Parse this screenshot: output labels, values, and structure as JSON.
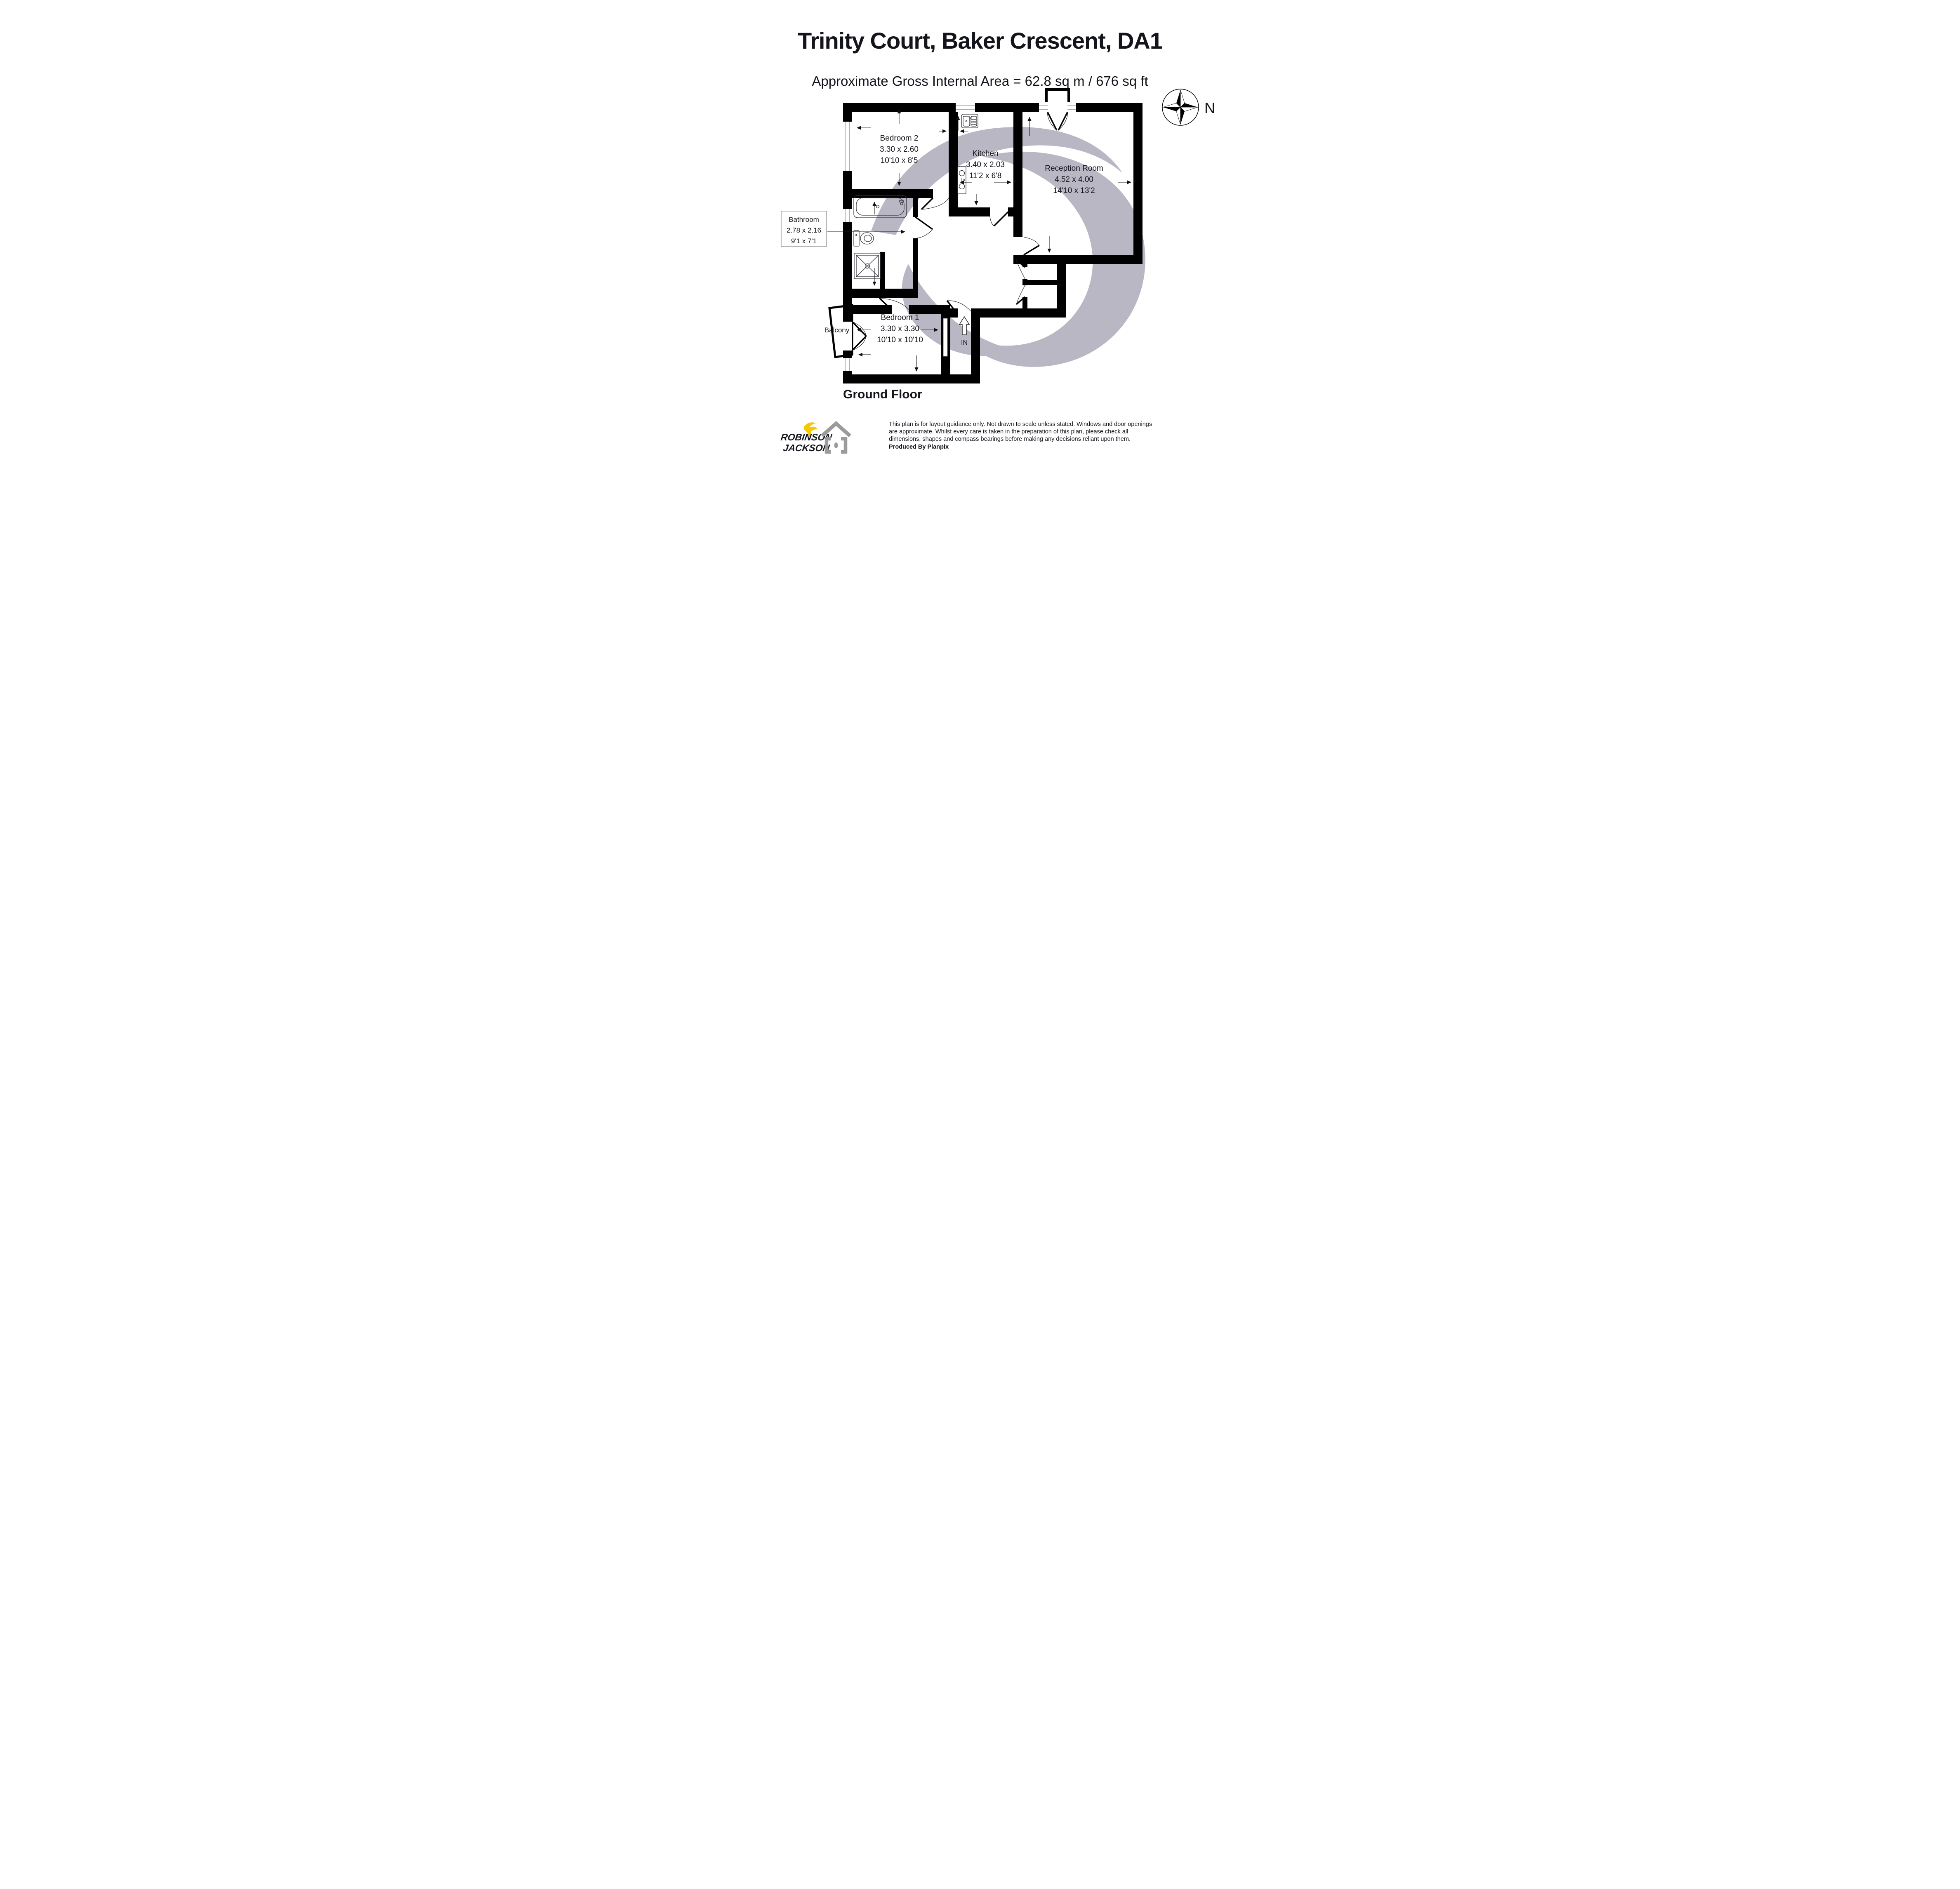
{
  "header": {
    "title": "Trinity Court, Baker Crescent, DA1",
    "subtitle": "Approximate Gross Internal Area = 62.8 sq m / 676 sq ft"
  },
  "compass": {
    "north_label": "N"
  },
  "plan": {
    "rooms": [
      {
        "id": "bedroom-2",
        "name": "Bedroom 2",
        "metric": "3.30 x 2.60",
        "imperial": "10'10 x 8'5"
      },
      {
        "id": "kitchen",
        "name": "Kitchen",
        "metric": "3.40 x 2.03",
        "imperial": "11'2 x 6'8"
      },
      {
        "id": "reception-room",
        "name": "Reception Room",
        "metric": "4.52 x 4.00",
        "imperial": "14'10 x 13'2"
      },
      {
        "id": "bathroom",
        "name": "Bathroom",
        "metric": "2.78 x 2.16",
        "imperial": "9'1 x 7'1"
      },
      {
        "id": "bedroom-1",
        "name": "Bedroom 1",
        "metric": "3.30 x 3.30",
        "imperial": "10'10 x 10'10"
      },
      {
        "id": "balcony",
        "name": "Balcony"
      }
    ],
    "entrance_label": "IN",
    "floor_label": "Ground Floor"
  },
  "footer": {
    "agency_logo": {
      "line1": "ROBINSON",
      "line2": "JACKSON"
    },
    "disclaimer": [
      "This plan is for layout guidance only. Not drawn to scale unless stated. Windows and door openings",
      "are approximate. Whilst every care is taken in the preparation of this plan, please check all",
      "dimensions, shapes and compass bearings before making any decisions reliant upon them."
    ],
    "produced_by": "Produced By Planpix"
  },
  "colors": {
    "wall": "#000000",
    "watermark": "#b9b7c4",
    "logo_navy": "#29284e",
    "logo_yellow": "#f7c800",
    "planpix_gray": "#9b9b9b"
  }
}
